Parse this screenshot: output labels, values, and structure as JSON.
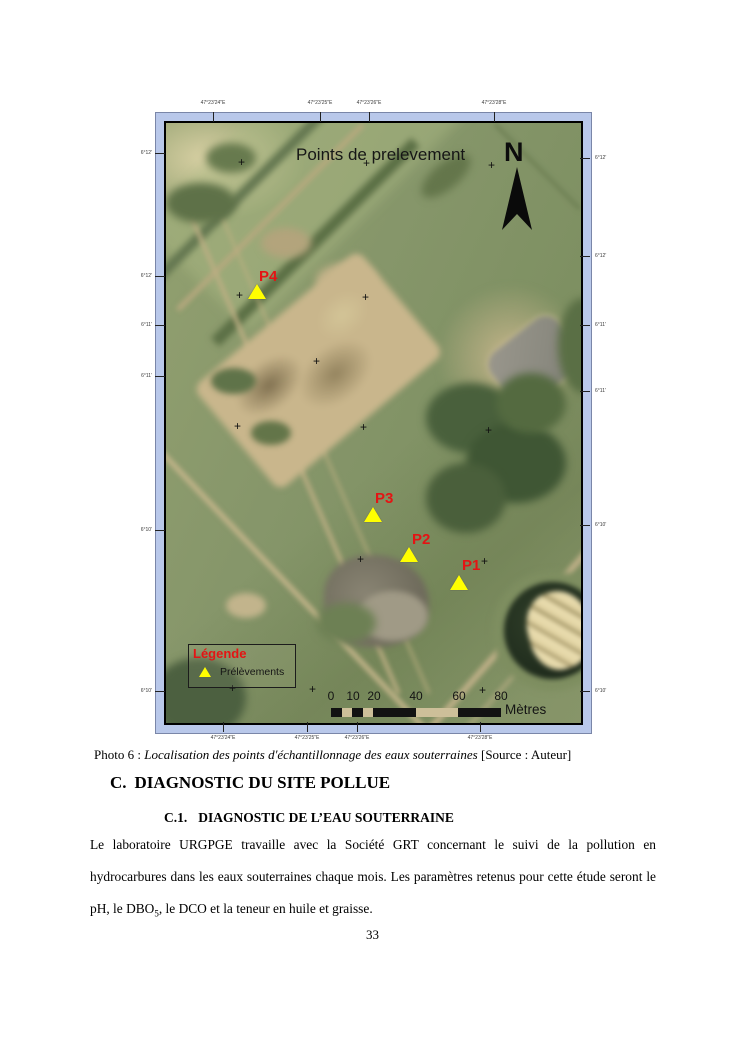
{
  "map": {
    "title": "Points de prelevement",
    "north_label": "N",
    "cross_glyph": "+",
    "crosses": [
      [
        77,
        40
      ],
      [
        202,
        41
      ],
      [
        327,
        43
      ],
      [
        75,
        173
      ],
      [
        201,
        175
      ],
      [
        152,
        239
      ],
      [
        73,
        304
      ],
      [
        199,
        305
      ],
      [
        324,
        308
      ],
      [
        196,
        437
      ],
      [
        320,
        439
      ],
      [
        68,
        566
      ],
      [
        148,
        567
      ],
      [
        318,
        568
      ]
    ],
    "points": [
      {
        "label": "P4",
        "x": 91,
        "y": 169,
        "lx": 93,
        "ly": 146
      },
      {
        "label": "P3",
        "x": 207,
        "y": 392,
        "lx": 209,
        "ly": 368
      },
      {
        "label": "P2",
        "x": 243,
        "y": 432,
        "lx": 246,
        "ly": 409
      },
      {
        "label": "P1",
        "x": 293,
        "y": 460,
        "lx": 296,
        "ly": 435
      }
    ],
    "legend": {
      "title": "Légende",
      "item_label": "Prélèvements"
    },
    "scalebar": {
      "labels": [
        {
          "t": "0",
          "x": 165
        },
        {
          "t": "10",
          "x": 187
        },
        {
          "t": "20",
          "x": 208
        },
        {
          "t": "40",
          "x": 250
        },
        {
          "t": "60",
          "x": 293
        },
        {
          "t": "80",
          "x": 335
        }
      ],
      "segments": [
        {
          "w": 11,
          "c": "dark"
        },
        {
          "w": 10,
          "c": "light"
        },
        {
          "w": 11,
          "c": "dark"
        },
        {
          "w": 10,
          "c": "light"
        },
        {
          "w": 43,
          "c": "dark"
        },
        {
          "w": 42,
          "c": "light"
        },
        {
          "w": 43,
          "c": "dark"
        }
      ],
      "unit": "Mètres"
    },
    "graticule": {
      "top": [
        {
          "t": "47°23'24\"E",
          "x": 213
        },
        {
          "t": "47°23'25\"E",
          "x": 320
        },
        {
          "t": "47°23'26\"E",
          "x": 369
        },
        {
          "t": "47°23'28\"E",
          "x": 494
        }
      ],
      "bottom": [
        {
          "t": "47°23'24\"E",
          "x": 223
        },
        {
          "t": "47°23'25\"E",
          "x": 307
        },
        {
          "t": "47°23'26\"E",
          "x": 357
        },
        {
          "t": "47°23'28\"E",
          "x": 480
        }
      ],
      "left": [
        {
          "t": "6°12'",
          "y": 153
        },
        {
          "t": "6°12'",
          "y": 276
        },
        {
          "t": "6°11'",
          "y": 325
        },
        {
          "t": "6°11'",
          "y": 376
        },
        {
          "t": "6°10'",
          "y": 530
        },
        {
          "t": "6°10'",
          "y": 691
        }
      ],
      "right": [
        {
          "t": "6°12'",
          "y": 158
        },
        {
          "t": "6°12'",
          "y": 256
        },
        {
          "t": "6°11'",
          "y": 325
        },
        {
          "t": "6°11'",
          "y": 391
        },
        {
          "t": "6°10'",
          "y": 525
        },
        {
          "t": "6°10'",
          "y": 691
        }
      ]
    },
    "colors": {
      "frame": "#b9c8ea",
      "point_label": "#e41414",
      "marker": "#ffff00"
    }
  },
  "caption": {
    "prefix": "Photo 6 : ",
    "italic": "Localisation des points d'échantillonnage des eaux souterraines",
    "source": " [Source : Auteur]"
  },
  "sections": {
    "heading_number": "C.",
    "heading_text": "DIAGNOSTIC DU SITE POLLUE",
    "sub_number": "C.1.",
    "sub_text": "DIAGNOSTIC DE L’EAU SOUTERRAINE"
  },
  "body": {
    "text1": "Le laboratoire URGPGE travaille avec la Société GRT concernant le suivi de la pollution en hydrocarbures dans les eaux souterraines chaque mois. Les paramètres retenus pour cette étude seront le pH, le DBO",
    "sub": "5",
    "text2": ", le DCO et la teneur en huile et graisse."
  },
  "page_number": "33"
}
